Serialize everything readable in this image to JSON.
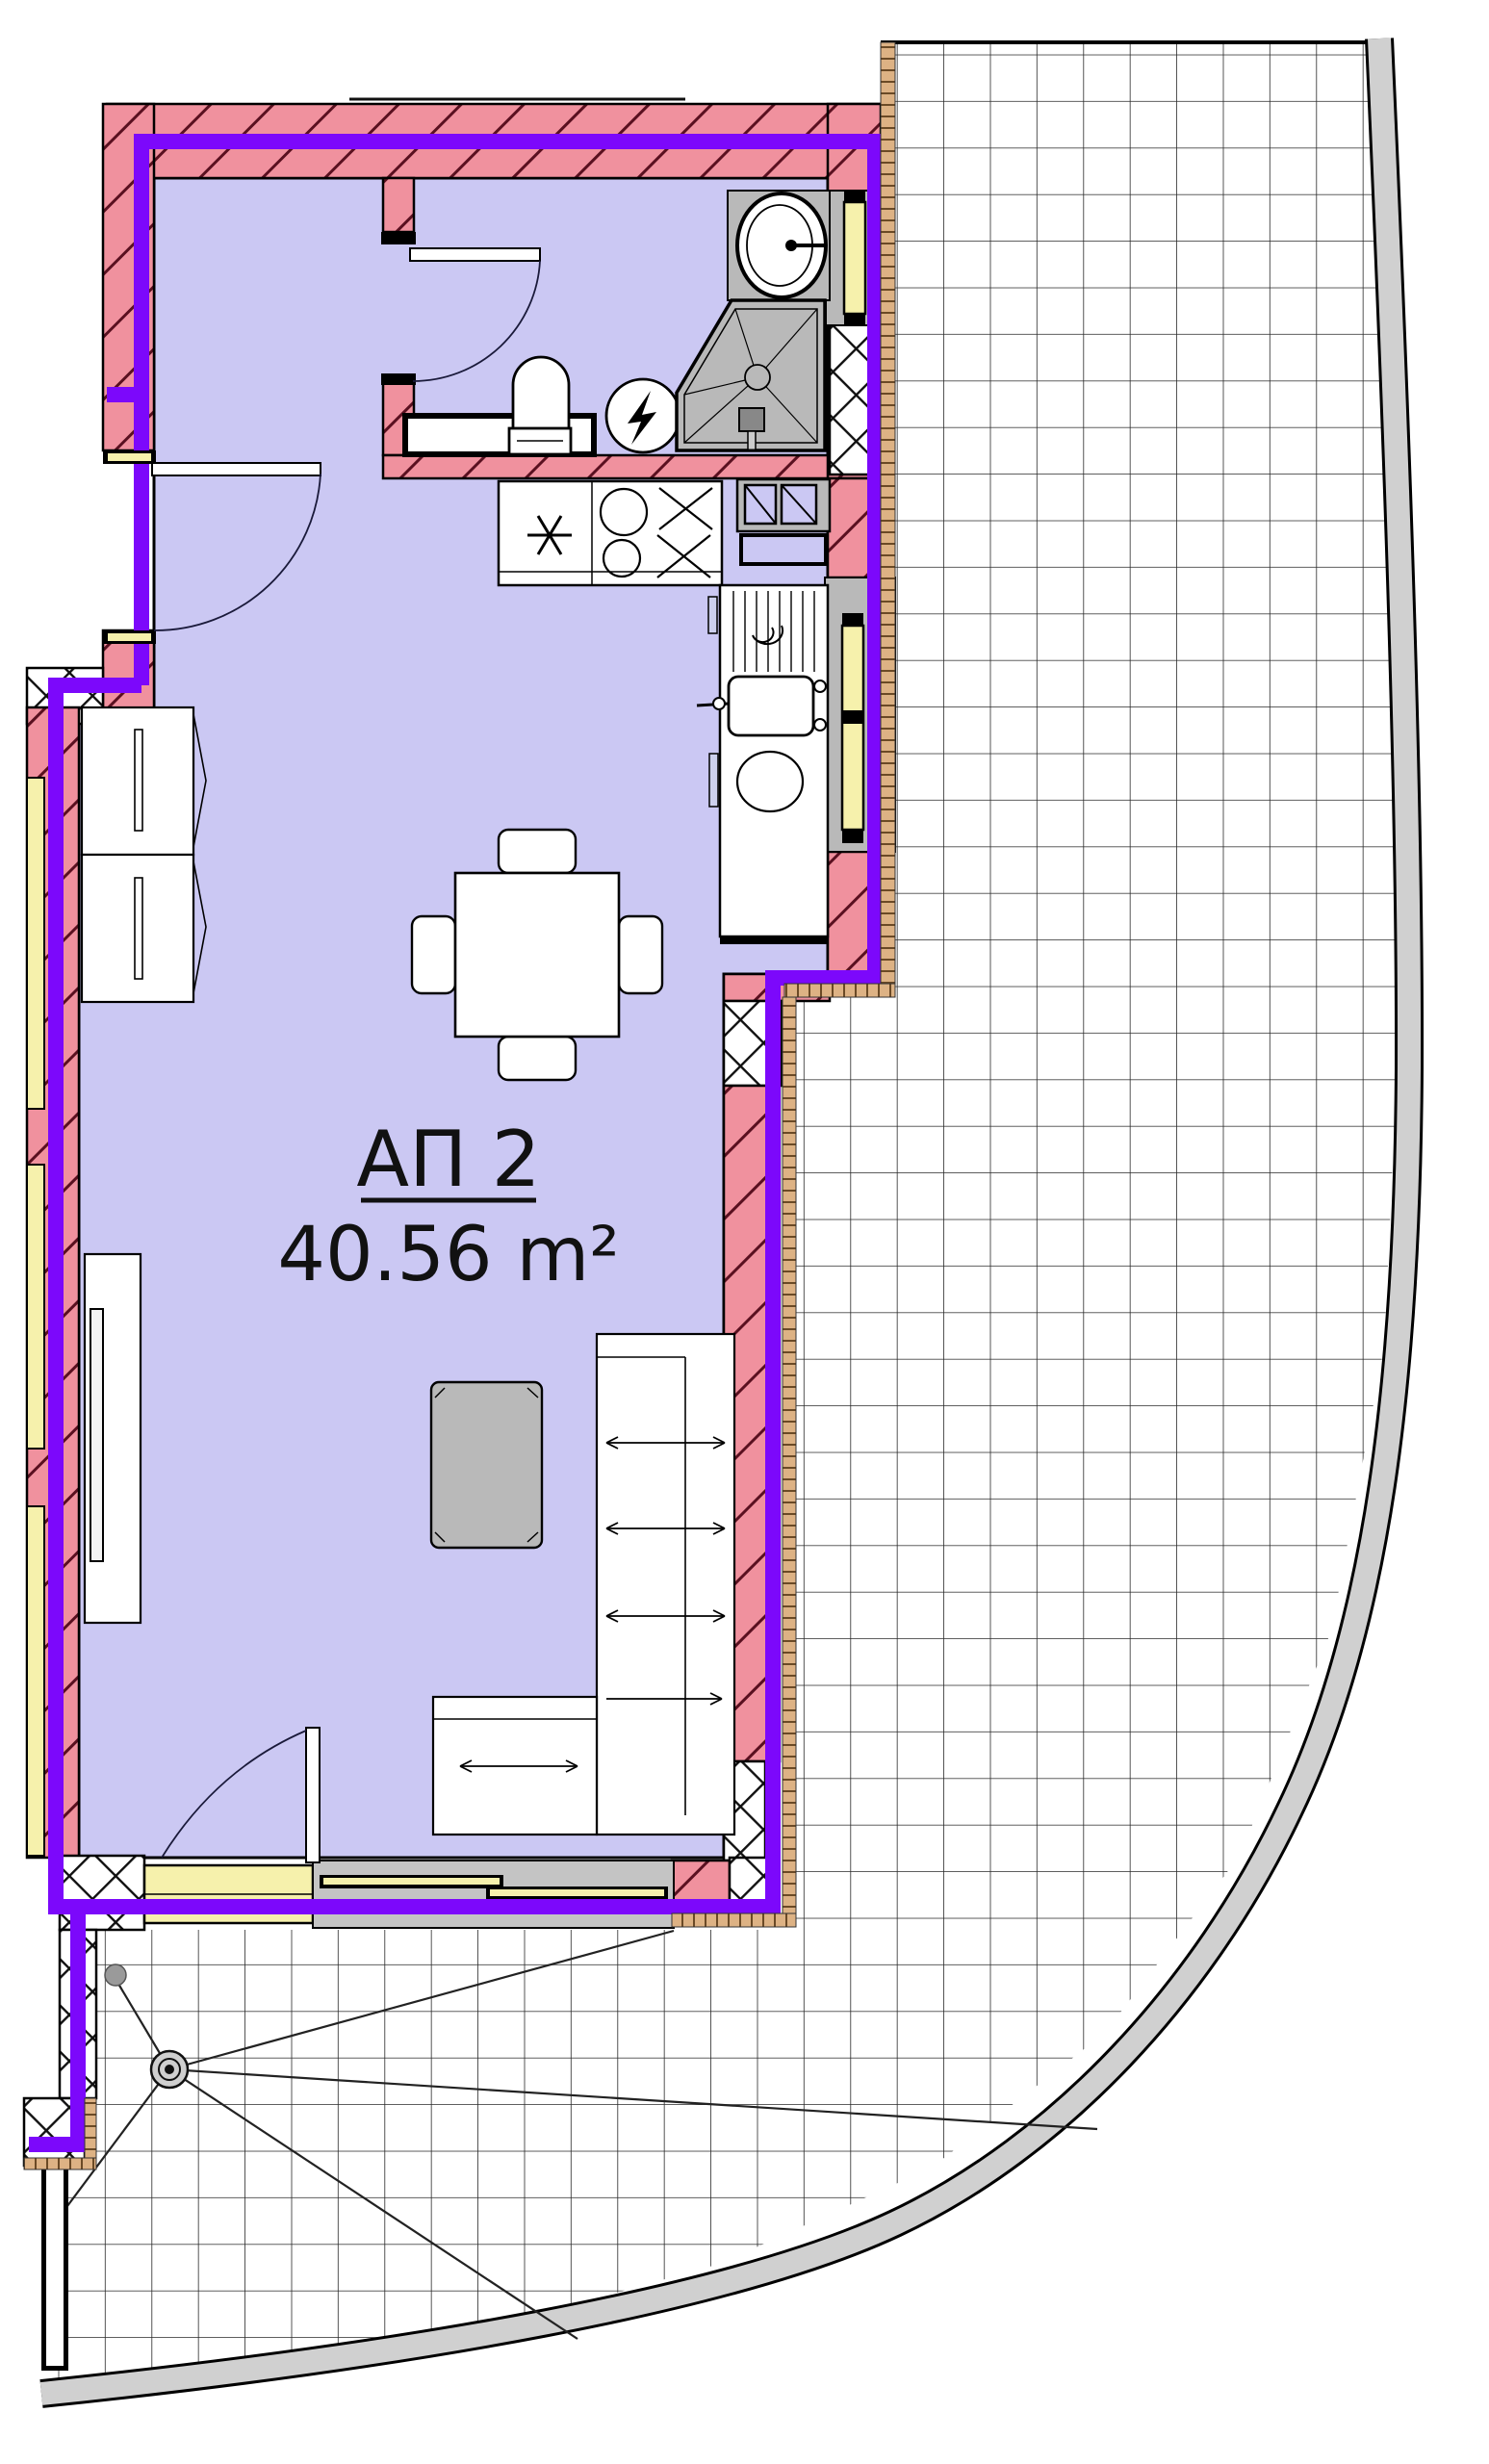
{
  "unit": {
    "name": "АП 2",
    "area": "40.56 m²"
  },
  "colors": {
    "floor": "#cbc8f3",
    "wall": "#f0919e",
    "wall_hatch": "#5a1020",
    "insulation": "#7c08fb",
    "window": "#f6f1ac",
    "fixture_gray": "#b9b9b9",
    "slider_gray": "#c4c4c4",
    "terrace_edge": "#d0d0d0",
    "trim_tan": "#ddb284",
    "line": "#000000"
  },
  "fixtures": [
    "washbasin",
    "toilet",
    "shower-cabin",
    "water-heater",
    "vanity-counter",
    "kitchen-counter",
    "cooktop",
    "dishwasher",
    "kitchen-sink",
    "washing-machine",
    "dining-table",
    "dining-chair",
    "wardrobe",
    "tv-cabinet",
    "coffee-table",
    "corner-sofa",
    "floor-drain",
    "terrace-tiles",
    "sliding-door",
    "window",
    "door"
  ]
}
